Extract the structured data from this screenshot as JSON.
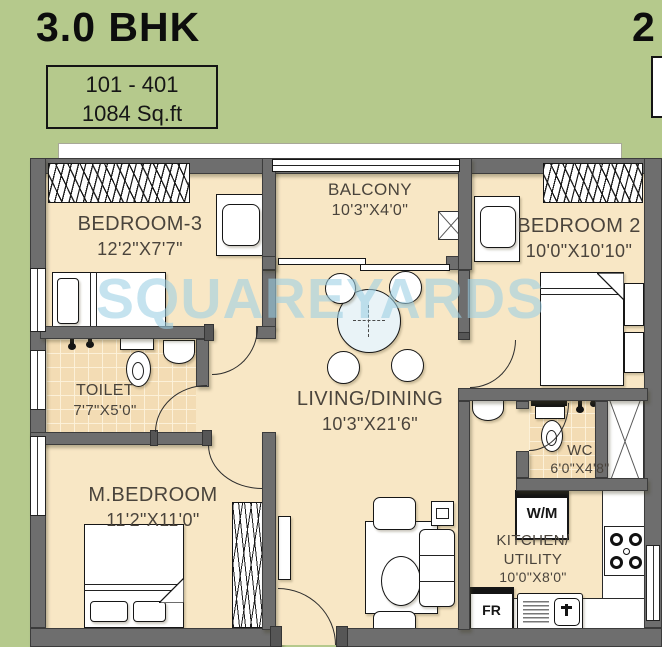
{
  "header": {
    "title": "3.0 BHK",
    "unit_range": "101 - 401",
    "area": "1084 Sq.ft",
    "adjacent_title_partial": "2"
  },
  "watermark": "SQUAREYARDS",
  "rooms": {
    "bedroom3": {
      "name": "BEDROOM-3",
      "dims": "12'2\"X7'7\""
    },
    "balcony": {
      "name": "BALCONY",
      "dims": "10'3\"X4'0\""
    },
    "bedroom2": {
      "name": "BEDROOM 2",
      "dims": "10'0\"X10'10\""
    },
    "toilet": {
      "name": "TOILET",
      "dims": "7'7\"X5'0\""
    },
    "living": {
      "name": "LIVING/DINING",
      "dims": "10'3\"X21'6\""
    },
    "mbedroom": {
      "name": "M.BEDROOM",
      "dims": "11'2\"X11'0\""
    },
    "wc": {
      "name": "WC",
      "dims": "6'0\"X4'8\""
    },
    "kitchen": {
      "name": "KITCHEN/",
      "name2": "UTILITY",
      "dims": "10'0\"X8'0\""
    }
  },
  "appliances": {
    "washing_machine": "W/M",
    "fridge": "FR"
  },
  "colors": {
    "background": "#b5c98c",
    "floor": "#f8e7c5",
    "tile": "#f3dcb4",
    "wall": "#6e6e6e",
    "watermark": "#9ccfe4",
    "counter": "#ffffff"
  }
}
